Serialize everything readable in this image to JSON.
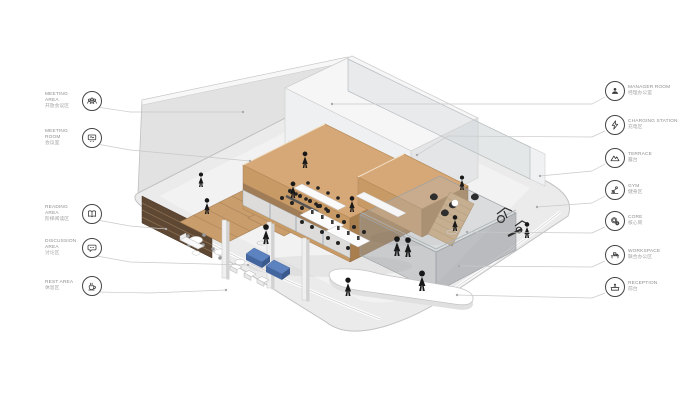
{
  "diagram_title": "office axonometric floor diagram",
  "labels": {
    "left": [
      {
        "en": "MEETING AREA",
        "zh": "开放会议区",
        "icon": "meeting-area-icon"
      },
      {
        "en": "MEETING ROOM",
        "zh": "会议室",
        "icon": "meeting-room-icon"
      },
      {
        "en": "READING AREA",
        "zh": "阶梯阅读区",
        "icon": "reading-area-icon"
      },
      {
        "en": "DISCUSSION AREA",
        "zh": "讨论区",
        "icon": "discussion-area-icon"
      },
      {
        "en": "REST AREA",
        "zh": "休息区",
        "icon": "rest-area-icon"
      }
    ],
    "right": [
      {
        "en": "MANAGER ROOM",
        "zh": "经理办公室",
        "icon": "manager-room-icon"
      },
      {
        "en": "CHARGING STATION",
        "zh": "充电区",
        "icon": "charging-station-icon"
      },
      {
        "en": "TERRACE",
        "zh": "露台",
        "icon": "terrace-icon"
      },
      {
        "en": "GYM",
        "zh": "健身区",
        "icon": "gym-icon"
      },
      {
        "en": "CORE",
        "zh": "核心筒",
        "icon": "core-icon"
      },
      {
        "en": "WORKSPACE",
        "zh": "联合办公区",
        "icon": "workspace-icon"
      },
      {
        "en": "RECEPTION",
        "zh": "前台",
        "icon": "reception-icon"
      }
    ]
  },
  "colors": {
    "wood_top": "#d7a877",
    "wood_front": "#c89a66",
    "wood_side": "#a87e4f",
    "wall": "#e2e2e2",
    "floor": "#ebebeb",
    "glass": "rgba(205,212,216,0.35)",
    "accent_blue": "#5c82c0",
    "figure_black": "#181818",
    "label_text": "#8d8d8d",
    "icon_stroke": "#3a3a3a",
    "leader_line": "#cccccc"
  },
  "illustration": {
    "type": "isometric interior cutaway",
    "elements": [
      "floor slab",
      "back walls",
      "wooden meeting room box",
      "wooden manager box",
      "tiered reading stairs",
      "bookshelf wall",
      "workspace desks",
      "blue discussion sofas",
      "white rest sofas",
      "curved reception desk",
      "terrace platform with lounge chairs",
      "gym equipment",
      "stairs to terrace",
      "columns",
      "people silhouettes"
    ]
  }
}
